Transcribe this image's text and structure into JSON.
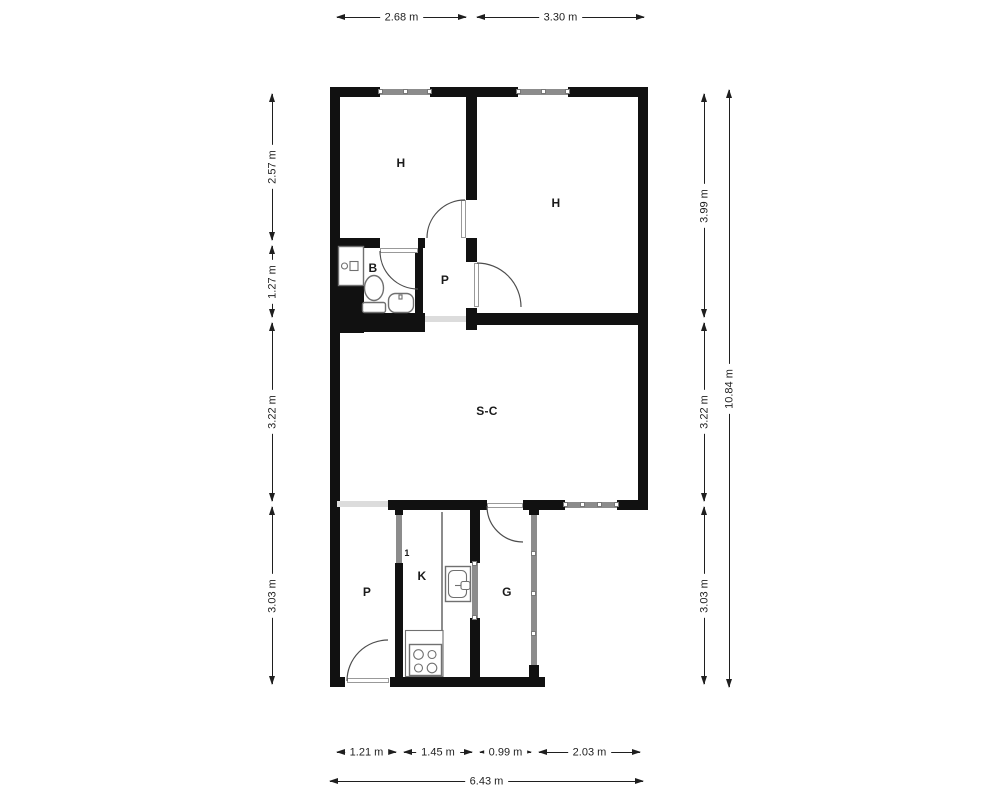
{
  "plan": {
    "rooms": {
      "bedroom_left": "H",
      "bedroom_right": "H",
      "bathroom": "B",
      "hallway": "P",
      "living_dining": "S-C",
      "pantry": "P",
      "kitchen": "K",
      "gallery": "G",
      "door_marker": "1"
    },
    "dimensions": {
      "top": [
        "2.68 m",
        "3.30 m"
      ],
      "left": [
        "2.57 m",
        "1.27 m",
        "3.22 m",
        "3.03 m"
      ],
      "right": [
        "3.99 m",
        "3.22 m",
        "3.03 m"
      ],
      "right_total": "10.84 m",
      "bottom": [
        "1.21 m",
        "1.45 m",
        "0.99 m",
        "2.03 m"
      ],
      "bottom_total": "6.43 m"
    },
    "colors": {
      "wall": "#111111",
      "glazing": "#8c8c8c",
      "opening": "#dcdcdc",
      "door": "#999999",
      "arc": "#4d4d4d",
      "fixture": "#707070",
      "dimension": "#1f1f1f",
      "background": "#ffffff"
    }
  }
}
